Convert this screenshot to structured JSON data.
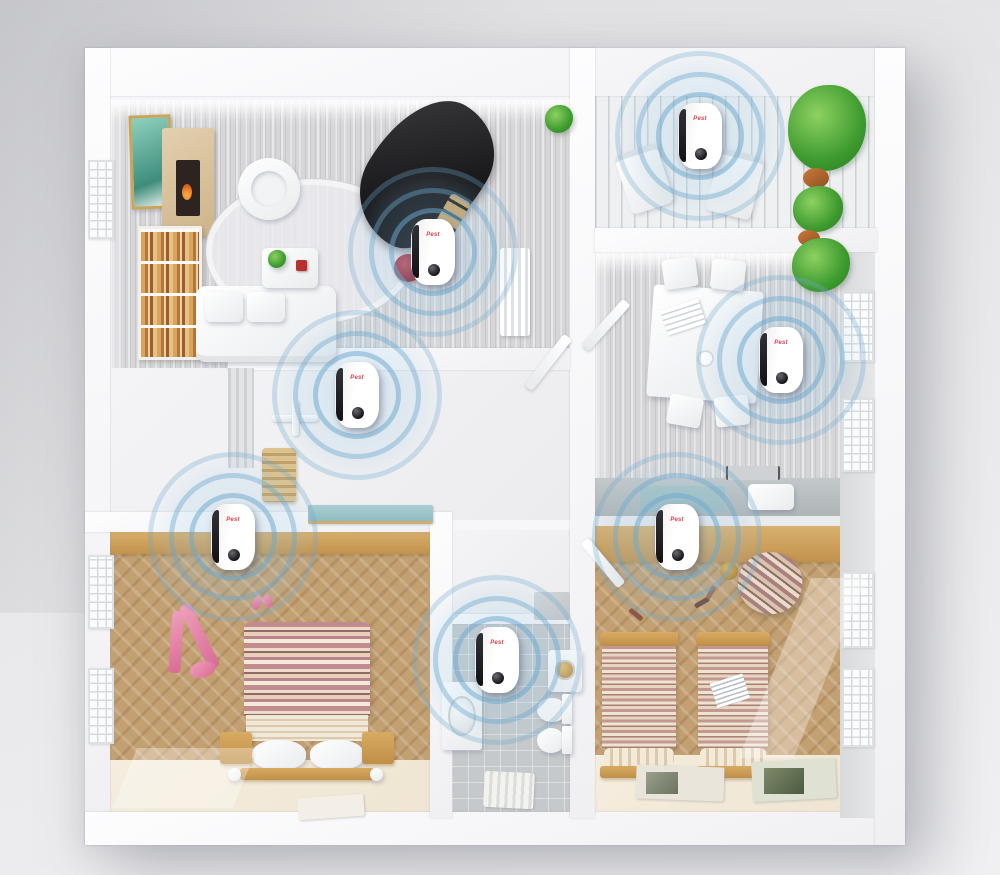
{
  "scene": {
    "type": "3d-floor-plan-product-render",
    "background_color": "#e8e8ea",
    "wall_color": "#f7f7f9"
  },
  "palette": {
    "floor_gray_wood": "#d6d6d8",
    "floor_white_plank": "#eef0f1",
    "floor_herringbone": "#c3a072",
    "floor_tile": "#c6c9cb",
    "counter_gray": "#b9bfc1",
    "wood_tan": "#cd9a52",
    "ring_blue": "#6ca8cd",
    "logo_red": "#d8434e"
  },
  "device": {
    "brand_label": "Pest",
    "count": 7,
    "body_color": "#ffffff",
    "side_stripe_color": "#1c1c20",
    "speaker_color": "#141416"
  },
  "devices": [
    {
      "room": "balcony",
      "x": 70.0,
      "y": 15.5
    },
    {
      "room": "living-room",
      "x": 43.3,
      "y": 28.8
    },
    {
      "room": "hallway",
      "x": 35.7,
      "y": 45.1
    },
    {
      "room": "master-bedroom",
      "x": 23.3,
      "y": 61.4
    },
    {
      "room": "kitchen-dining",
      "x": 78.1,
      "y": 41.1
    },
    {
      "room": "kids-bedroom",
      "x": 67.7,
      "y": 61.4
    },
    {
      "room": "bathroom",
      "x": 49.7,
      "y": 75.4
    }
  ],
  "rooms": [
    {
      "name": "living-room",
      "floor": "gray-wood"
    },
    {
      "name": "balcony",
      "floor": "white-plank"
    },
    {
      "name": "kitchen-dining",
      "floor": "gray-wood"
    },
    {
      "name": "hallway",
      "floor": "white"
    },
    {
      "name": "master-bedroom",
      "floor": "herringbone-wood"
    },
    {
      "name": "bathroom",
      "floor": "gray-tile"
    },
    {
      "name": "kids-bedroom",
      "floor": "herringbone-wood"
    }
  ]
}
